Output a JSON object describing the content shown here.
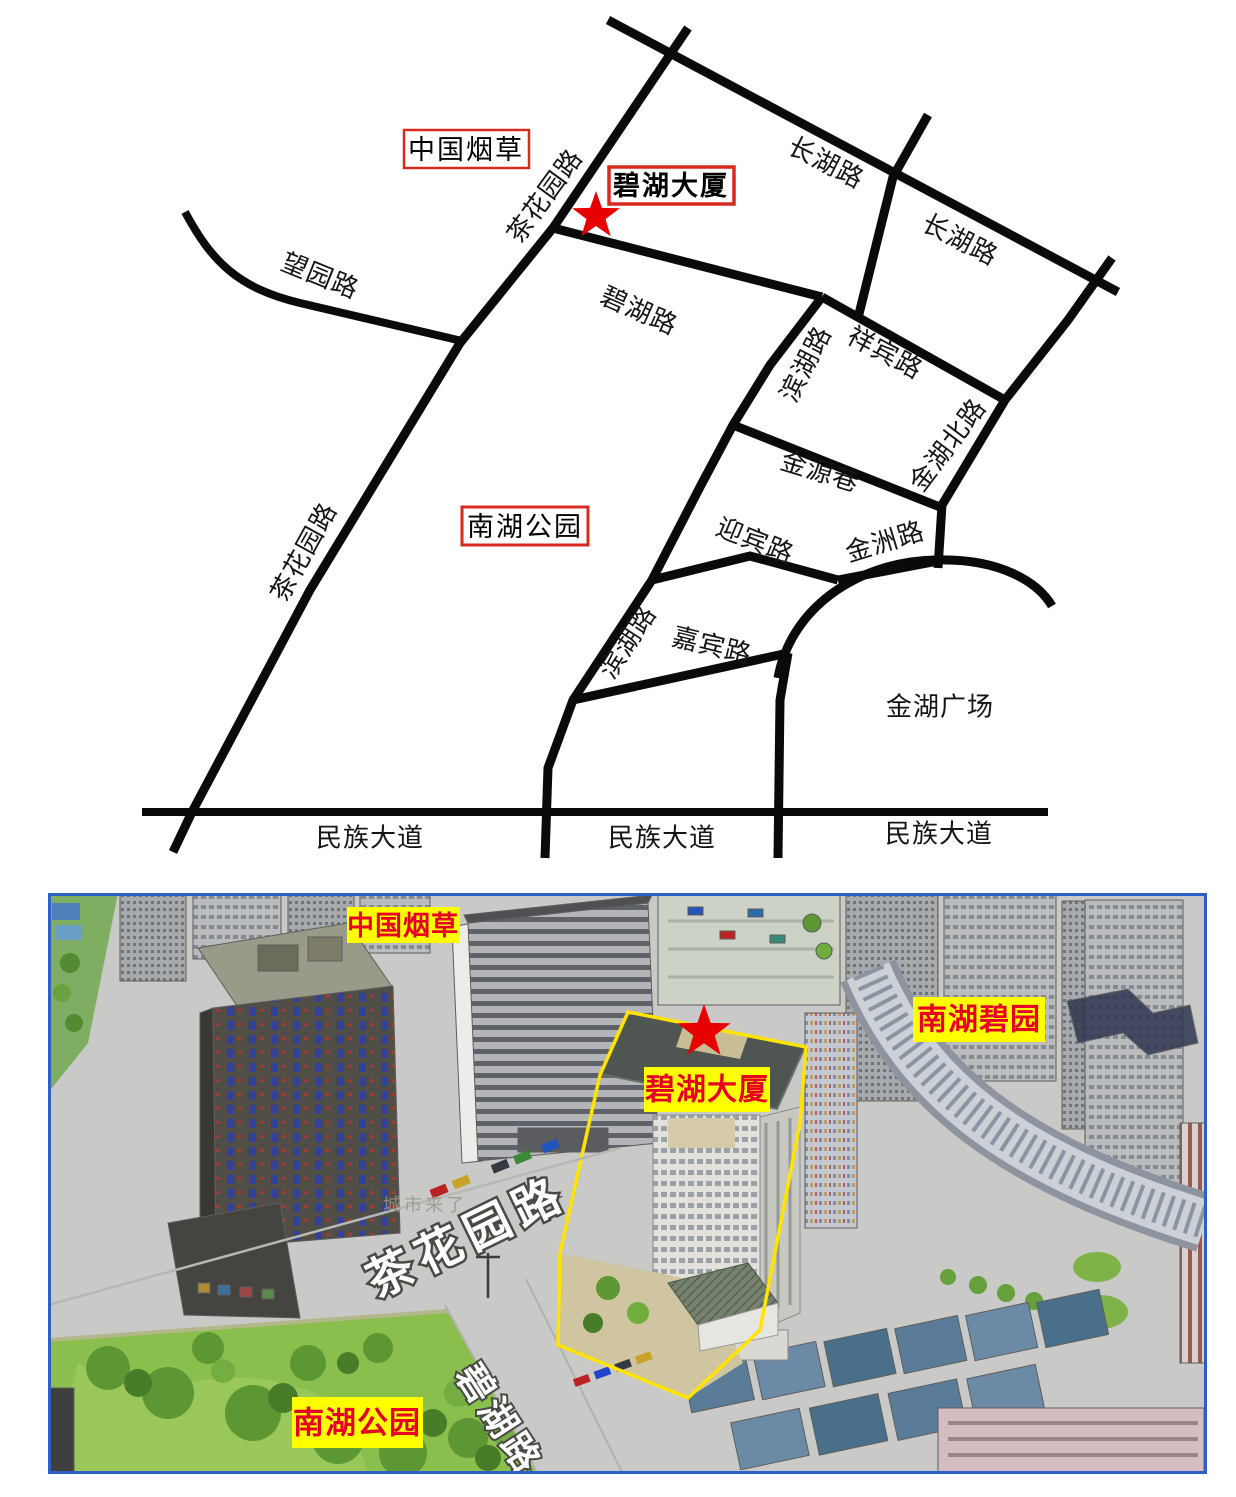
{
  "top_map": {
    "boxes": {
      "tobacco": "中国烟草",
      "tower": "碧湖大厦",
      "park": "南湖公园"
    },
    "roads": {
      "wangyuan": "望园路",
      "chahua_upper": "茶花园路",
      "chahua_lower": "茶花园路",
      "changhu_a": "长湖路",
      "changhu_b": "长湖路",
      "bihu": "碧湖路",
      "xiangbin": "祥宾路",
      "binhu_a": "滨湖路",
      "jinhubei": "金湖北路",
      "jinyuan": "金源巷",
      "yingbin": "迎宾路",
      "jinzhou": "金洲路",
      "jiabin": "嘉宾路",
      "binhu_b": "滨湖路",
      "minzu_a": "民族大道",
      "minzu_b": "民族大道",
      "minzu_c": "民族大道"
    },
    "areas": {
      "jinhu_square": "金湖广场"
    }
  },
  "photo": {
    "boxes": {
      "tobacco": "中国烟草",
      "biyuan": "南湖碧园",
      "tower": "碧湖大厦",
      "park": "南湖公园"
    },
    "roads": {
      "chahua": "茶花园路",
      "bihu": "碧湖路"
    },
    "watermark": "城市来了"
  },
  "colors": {
    "road": "#0a0a0a",
    "star": "#e60000",
    "map_box_border": "#d92a20",
    "label_bg": "#ffff00",
    "label_text": "#e60023",
    "frame": "#2e5fc9",
    "road_text": "#ffffff"
  }
}
